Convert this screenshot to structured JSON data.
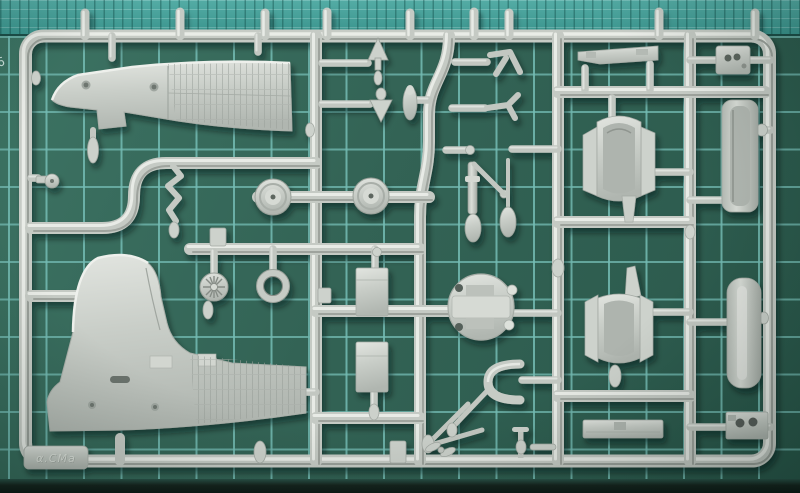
{
  "photo": {
    "subject": "Light grey injection-moulded aircraft model kit sprue photographed on a green self-healing cutting mat",
    "sprue_logo_text": "α.CMa",
    "mat_edge_marking": "6"
  },
  "colors": {
    "mat_green_dark": "#2a584b",
    "mat_green": "#3d7464",
    "mat_grid_line": "#74bcb4",
    "mat_top_band": "#49a09a",
    "mat_bottom_edge": "#0d1915",
    "plastic_base": "#c7ccc6",
    "plastic_highlight": "#e9ece7",
    "plastic_shadow": "#8f958f"
  },
  "parts_inventory": [
    "fuselage-half-forward",
    "fuselage-half-rear-with-tailfin",
    "main-wheel-left",
    "main-wheel-right",
    "spoked-wheel-hub",
    "cowl-ring",
    "engine-bulkhead-disc",
    "cowling-scoop-upper",
    "cowling-scoop-lower",
    "gun-trough-right",
    "drop-tank-half-right",
    "landing-gear-oleo-strut",
    "landing-gear-v-struts",
    "bomb-teardrop",
    "pitot-dart-up",
    "pitot-dart-down",
    "exhaust-stack-squiggle",
    "instrument-box-top-right",
    "radio-box-bottom-right",
    "boarding-step-rail",
    "floor-plate-bottom",
    "roll-bar-u-part",
    "tail-wheel",
    "engine-block-boxes",
    "sprue-corner-logo-tab"
  ]
}
